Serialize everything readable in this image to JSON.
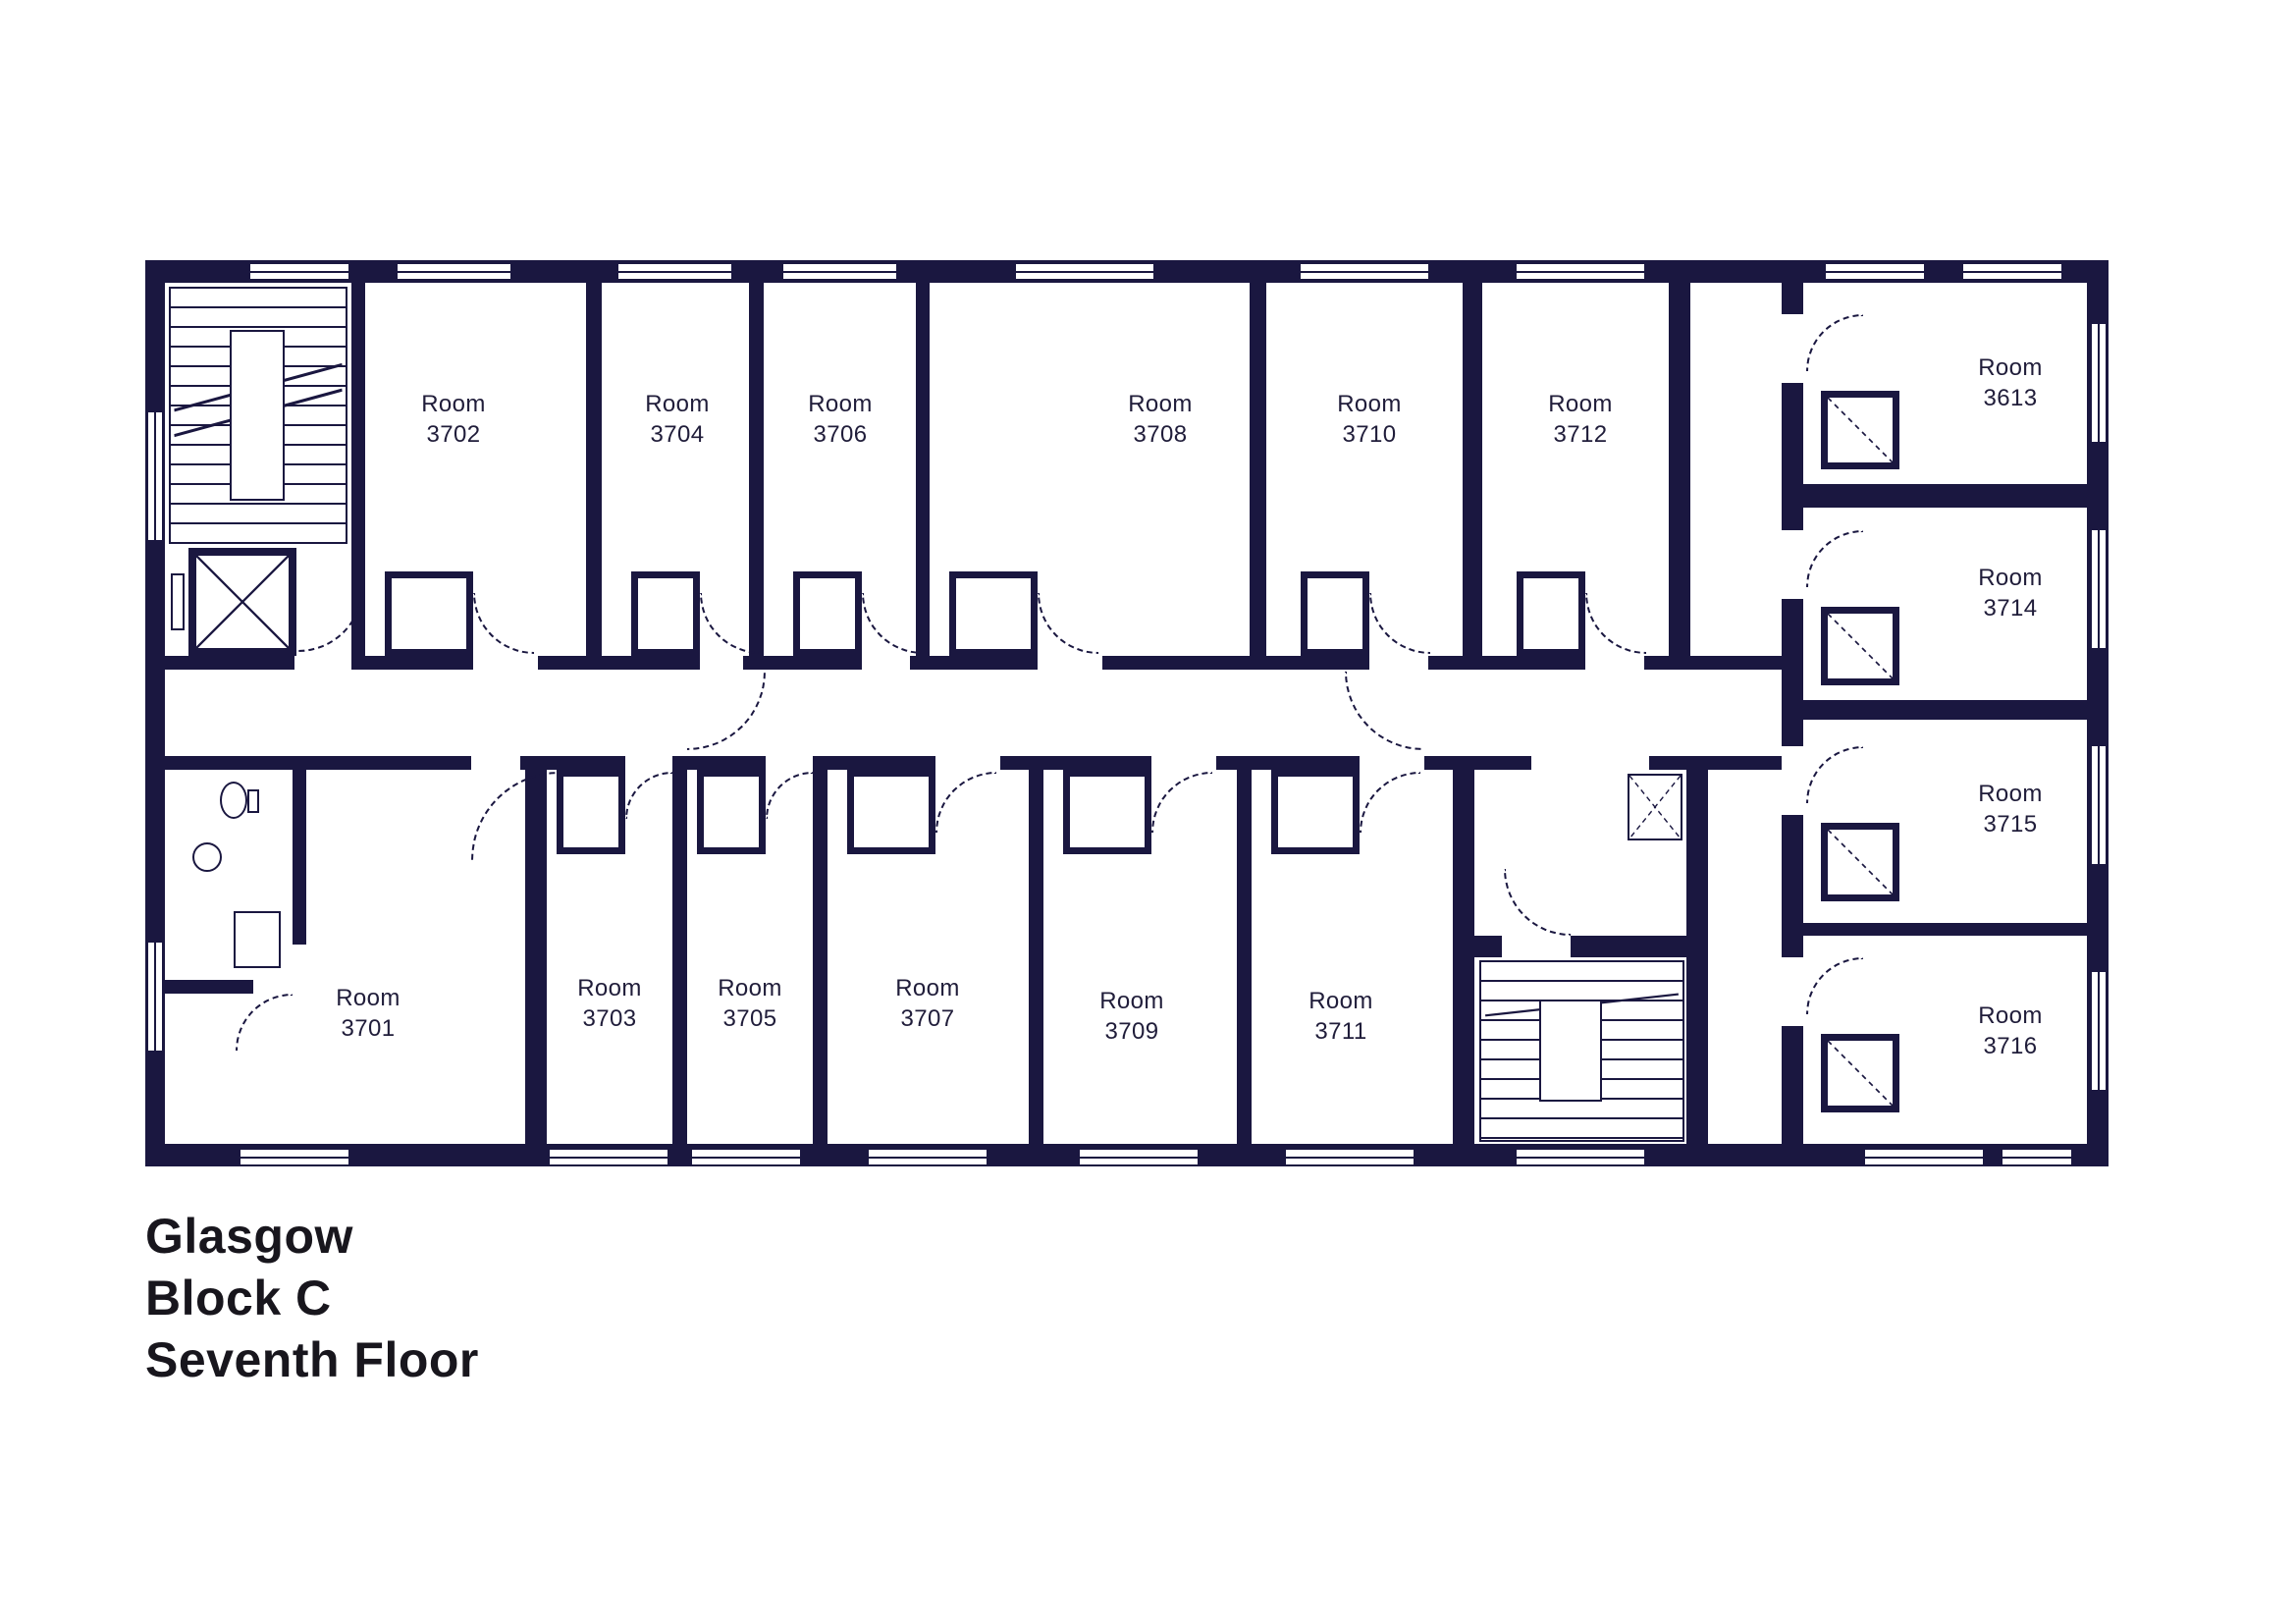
{
  "title": {
    "line1": "Glasgow",
    "line2": "Block C",
    "line3": "Seventh Floor"
  },
  "colors": {
    "wall": "#1a1740",
    "room_label": "#201d3a",
    "title_text": "#18161d"
  },
  "rooms": [
    {
      "id": "3702",
      "label": "Room\n3702"
    },
    {
      "id": "3704",
      "label": "Room\n3704"
    },
    {
      "id": "3706",
      "label": "Room\n3706"
    },
    {
      "id": "3708",
      "label": "Room\n3708"
    },
    {
      "id": "3710",
      "label": "Room\n3710"
    },
    {
      "id": "3712",
      "label": "Room\n3712"
    },
    {
      "id": "3613",
      "label": "Room\n3613"
    },
    {
      "id": "3714",
      "label": "Room\n3714"
    },
    {
      "id": "3715",
      "label": "Room\n3715"
    },
    {
      "id": "3716",
      "label": "Room\n3716"
    },
    {
      "id": "3701",
      "label": "Room\n3701"
    },
    {
      "id": "3703",
      "label": "Room\n3703"
    },
    {
      "id": "3705",
      "label": "Room\n3705"
    },
    {
      "id": "3707",
      "label": "Room\n3707"
    },
    {
      "id": "3709",
      "label": "Room\n3709"
    },
    {
      "id": "3711",
      "label": "Room\n3711"
    }
  ]
}
